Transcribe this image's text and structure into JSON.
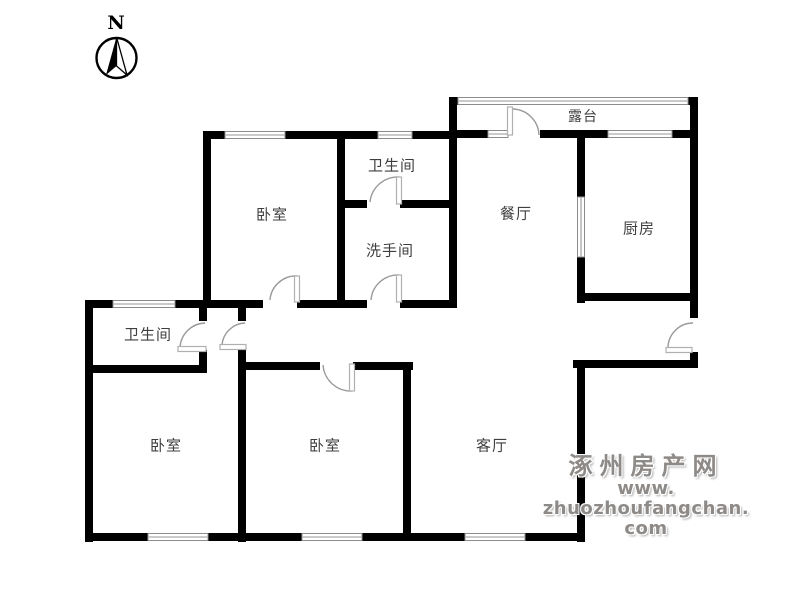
{
  "compass": {
    "label": "N"
  },
  "rooms": {
    "terrace": "露台",
    "bathroom_top": "卫生间",
    "washroom": "洗手间",
    "dining": "餐厅",
    "kitchen": "厨房",
    "bedroom_top": "卧室",
    "bathroom_left": "卫生间",
    "bedroom_bottom_left": "卧室",
    "bedroom_bottom_mid": "卧室",
    "living": "客厅"
  },
  "watermark": {
    "site_name": "涿州房产网",
    "site_url": "www. zhuozhoufangchan. com"
  },
  "colors": {
    "wall": "#000000",
    "door_arc": "#9a9a9a",
    "window_line": "#8c8c8c",
    "watermark_text": "#8e8a87"
  }
}
